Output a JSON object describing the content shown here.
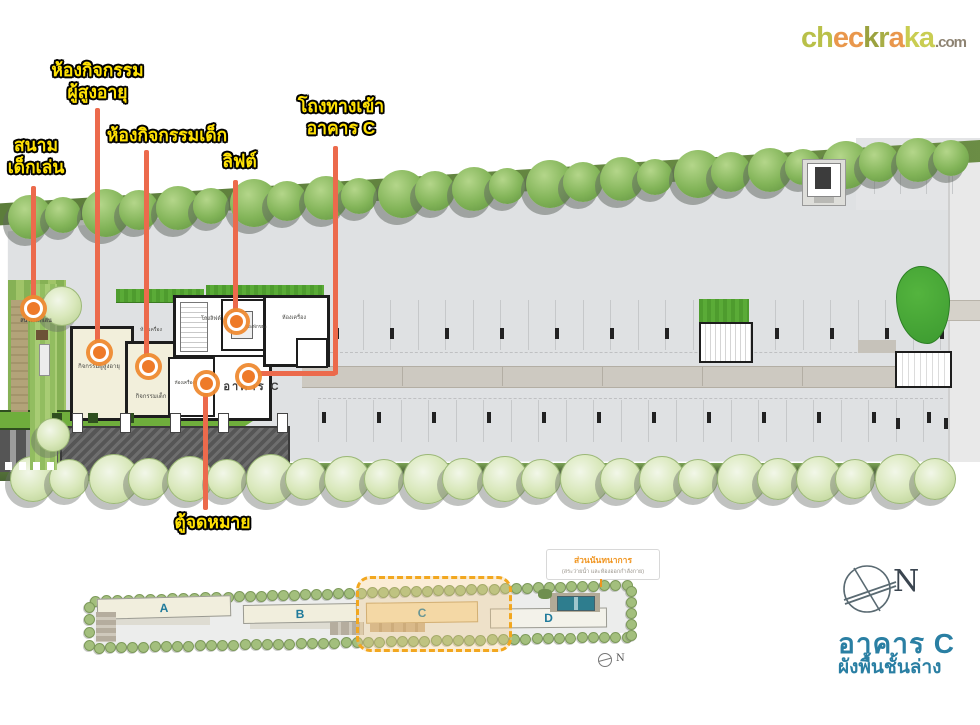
{
  "logo": {
    "letters": [
      {
        "ch": "c",
        "color": "#b9c049"
      },
      {
        "ch": "h",
        "color": "#b9c049"
      },
      {
        "ch": "e",
        "color": "#e9974c"
      },
      {
        "ch": "c",
        "color": "#e9974c"
      },
      {
        "ch": "k",
        "color": "#9ba23f"
      },
      {
        "ch": "r",
        "color": "#a8ae46"
      },
      {
        "ch": "a",
        "color": "#e9974c"
      },
      {
        "ch": "k",
        "color": "#c9cd52"
      },
      {
        "ch": "a",
        "color": "#c9cd52"
      }
    ],
    "suffix": ".com",
    "suffix_color": "#8d8372"
  },
  "annotations": {
    "elderly_room": {
      "line1": "ห้องกิจกรรม",
      "line2": "ผู้สูงอายุ"
    },
    "playground": {
      "line1": "สนาม",
      "line2": "เด็กเล่น"
    },
    "kids_room": {
      "label": "ห้องกิจกรรมเด็ก"
    },
    "lift": {
      "label": "ลิฟต์"
    },
    "entrance": {
      "line1": "โถงทางเข้า",
      "line2": "อาคาร C"
    },
    "mailbox": {
      "label": "ตู้จดหมาย"
    }
  },
  "floorplan": {
    "rooms": {
      "elderly": "กิจกรรมผู้สูงอายุ",
      "kids": "กิจกรรมเด็ก",
      "lift_hall": "โถงลิฟต์",
      "waste": "ห้องพักขยะ",
      "machine": "ห้องเครื่อง",
      "laundry": "ห้องเครื่องซักผ้า",
      "hall": "อาคาร C",
      "playground_small": "สนามเด็กเล่น"
    }
  },
  "minimap": {
    "buildings": [
      {
        "label": "A"
      },
      {
        "label": "B"
      },
      {
        "label": "C"
      },
      {
        "label": "D"
      }
    ],
    "recreation_title": "ส่วนนันทนาการ",
    "recreation_sub": "(สระว่ายน้ำ และห้องออกกำลังกาย)",
    "compass_n": "N"
  },
  "footer": {
    "compass_n": "N",
    "title": "อาคาร C",
    "subtitle": "ผังพื้นชั้นล่าง"
  },
  "colors": {
    "leader": "#ec6a4c",
    "marker": "#ee7a28",
    "label_yellow": "#ffe104",
    "title_teal": "#2a7fa3",
    "minimap_letter": "#1f7a9b",
    "dashed_orange": "#f2a71f"
  }
}
